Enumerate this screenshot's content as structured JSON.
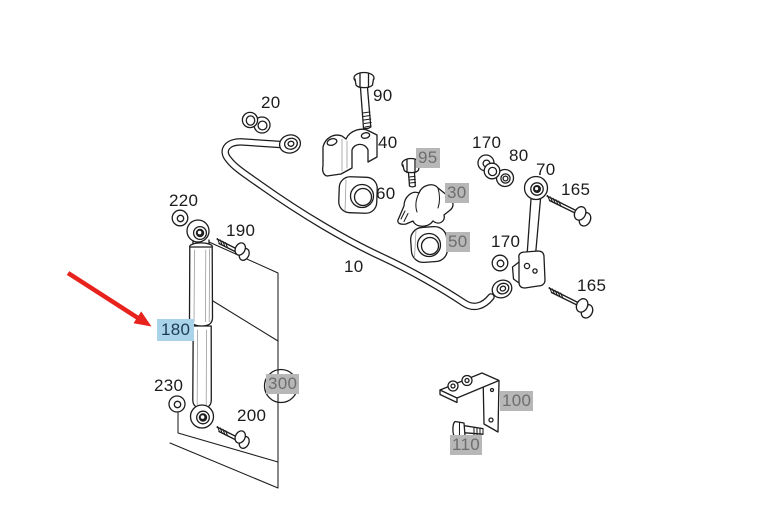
{
  "diagram": {
    "description": "rear suspension parts diagram: stabilizer bar, shock absorber, links and mounting hardware",
    "selected_callout": "180",
    "colors": {
      "line": "#1d1d1d",
      "selected_bg": "#a9d3e9",
      "selected_text": "#1d3a52",
      "group_bg": "#b7b7b7",
      "group_text": "#6e6e6e",
      "arrow": "#e8231e",
      "background": "#ffffff"
    },
    "callouts": [
      {
        "num": "20",
        "type": "plain"
      },
      {
        "num": "90",
        "type": "plain"
      },
      {
        "num": "40",
        "type": "plain"
      },
      {
        "num": "95",
        "type": "group"
      },
      {
        "num": "170",
        "type": "plain"
      },
      {
        "num": "80",
        "type": "plain"
      },
      {
        "num": "70",
        "type": "plain"
      },
      {
        "num": "165",
        "type": "plain"
      },
      {
        "num": "60",
        "type": "plain"
      },
      {
        "num": "30",
        "type": "group"
      },
      {
        "num": "50",
        "type": "group"
      },
      {
        "num": "170",
        "type": "plain"
      },
      {
        "num": "10",
        "type": "plain"
      },
      {
        "num": "165",
        "type": "plain"
      },
      {
        "num": "220",
        "type": "plain"
      },
      {
        "num": "190",
        "type": "plain"
      },
      {
        "num": "180",
        "type": "selected"
      },
      {
        "num": "230",
        "type": "plain"
      },
      {
        "num": "200",
        "type": "plain"
      },
      {
        "num": "300",
        "type": "group"
      },
      {
        "num": "100",
        "type": "group"
      },
      {
        "num": "110",
        "type": "group"
      }
    ]
  }
}
